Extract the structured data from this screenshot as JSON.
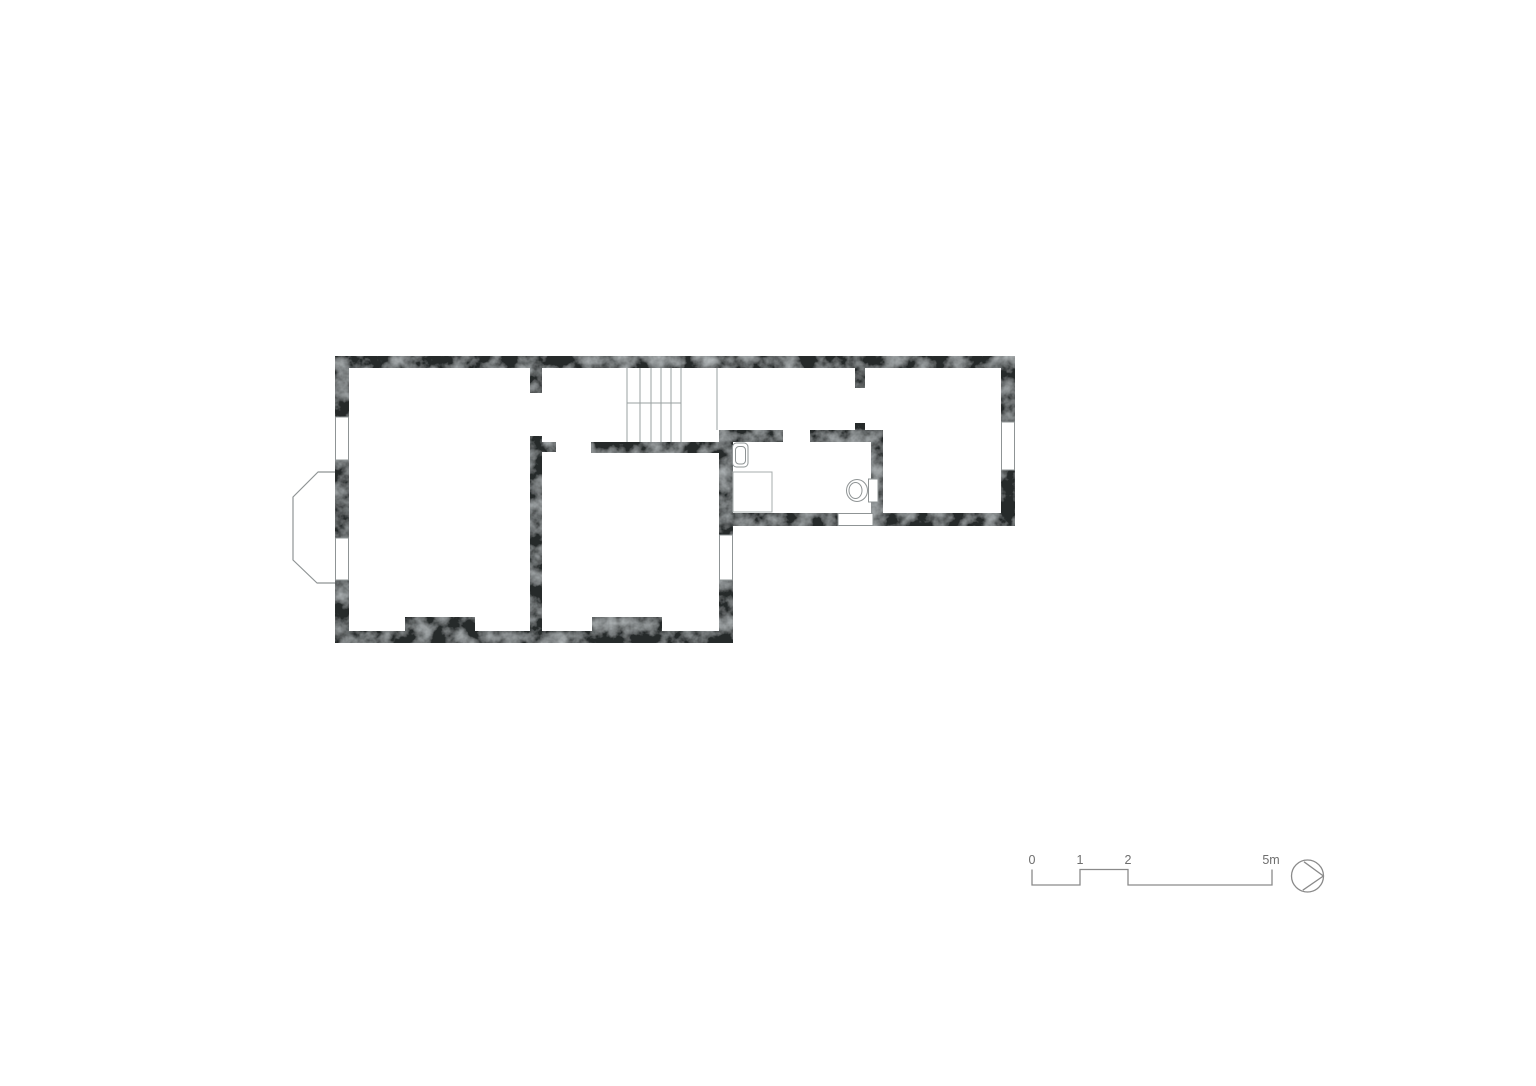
{
  "page": {
    "background": "#ffffff"
  },
  "plan": {
    "wall_color": "#26292a",
    "wall_texture_light": "#7a7f80",
    "thin_line_color": "#8f9495",
    "features": [
      {
        "name": "bay-window"
      },
      {
        "name": "staircase"
      },
      {
        "name": "fireplace-pier-left"
      },
      {
        "name": "fireplace-pier-middle"
      }
    ],
    "fixtures": [
      {
        "name": "sink"
      },
      {
        "name": "shower-tray"
      },
      {
        "name": "toilet"
      }
    ]
  },
  "scale_bar": {
    "labels": [
      "0",
      "1",
      "2",
      "5m"
    ],
    "line_color": "#8a8a8a",
    "text_color": "#6e6e6e"
  },
  "north_arrow": {
    "shape": "circle-with-inscribed-triangle-pointing-right",
    "color": "#8a8a8a"
  }
}
